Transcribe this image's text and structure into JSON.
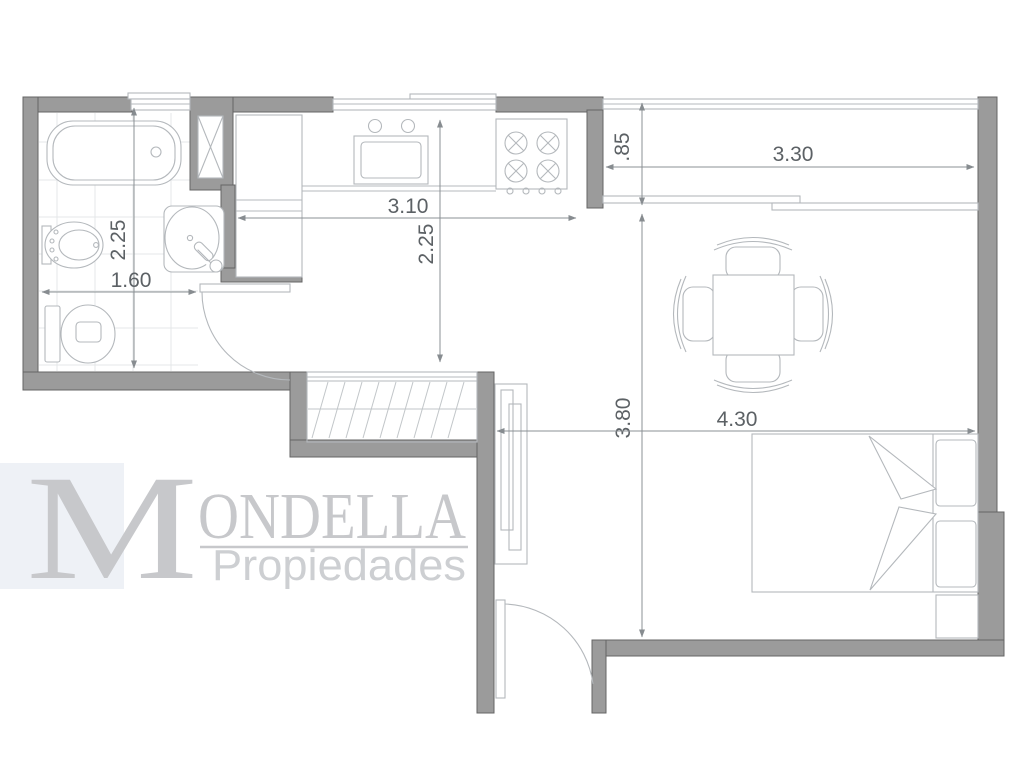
{
  "logo": {
    "initial": "M",
    "rest": "ONDELLA",
    "subtitle": "Propiedades"
  },
  "dimensions": {
    "bathroom_depth": "2.25",
    "bathroom_width": "1.60",
    "kitchen_width": "3.10",
    "kitchen_depth": "2.25",
    "balcony_depth": ".85",
    "balcony_width": "3.30",
    "living_depth": "3.80",
    "living_width": "4.30"
  },
  "colors": {
    "wall": "#9b9b9b",
    "wall_edge": "#646464",
    "fixture_line": "#b4b8bc",
    "dimension_text": "#5c6165",
    "tile": "#e4e7e9",
    "logo": "#c7c8cb",
    "background": "#ffffff"
  }
}
